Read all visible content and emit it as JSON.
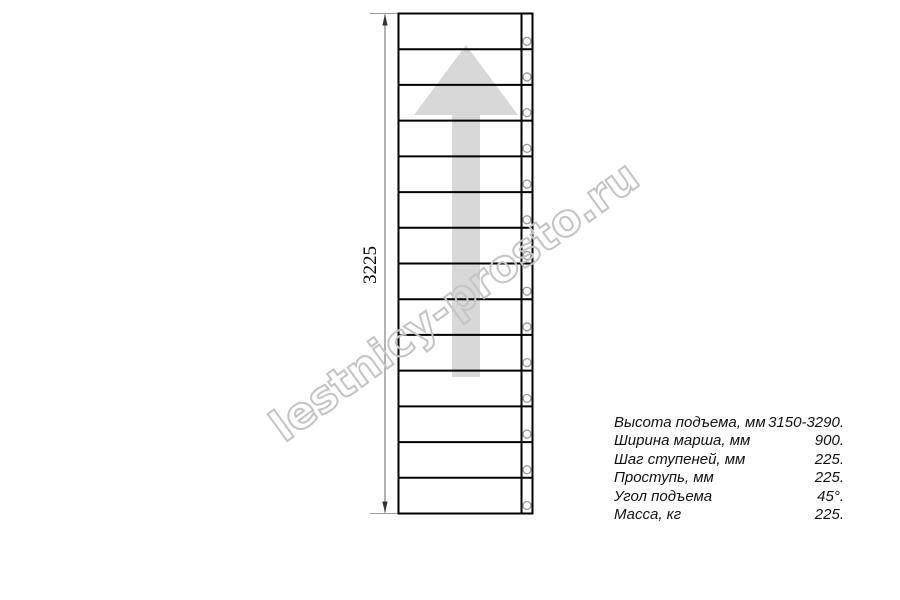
{
  "watermark": {
    "text": "lestnicy-prosto.ru",
    "color": "#c4c4c4"
  },
  "drawing": {
    "dimension_label": "3225",
    "stairs": {
      "steps": 14
    },
    "arrow_direction": "up",
    "colors": {
      "line": "#000000",
      "dim_line": "#808080",
      "ext_line": "#9a9a9a",
      "arrowhead": "#333333",
      "arrow_fill": "#d8d8d8",
      "circle": "#999999"
    }
  },
  "specs": {
    "rows": [
      {
        "label": "Высота подъема, мм",
        "value": "3150-3290."
      },
      {
        "label": "Ширина марша, мм",
        "value": "900."
      },
      {
        "label": "Шаг ступеней, мм",
        "value": "225."
      },
      {
        "label": "Проступь, мм",
        "value": "225."
      },
      {
        "label": "Угол подъема",
        "value": "45°."
      },
      {
        "label": "Масса, кг",
        "value": "225."
      }
    ]
  }
}
